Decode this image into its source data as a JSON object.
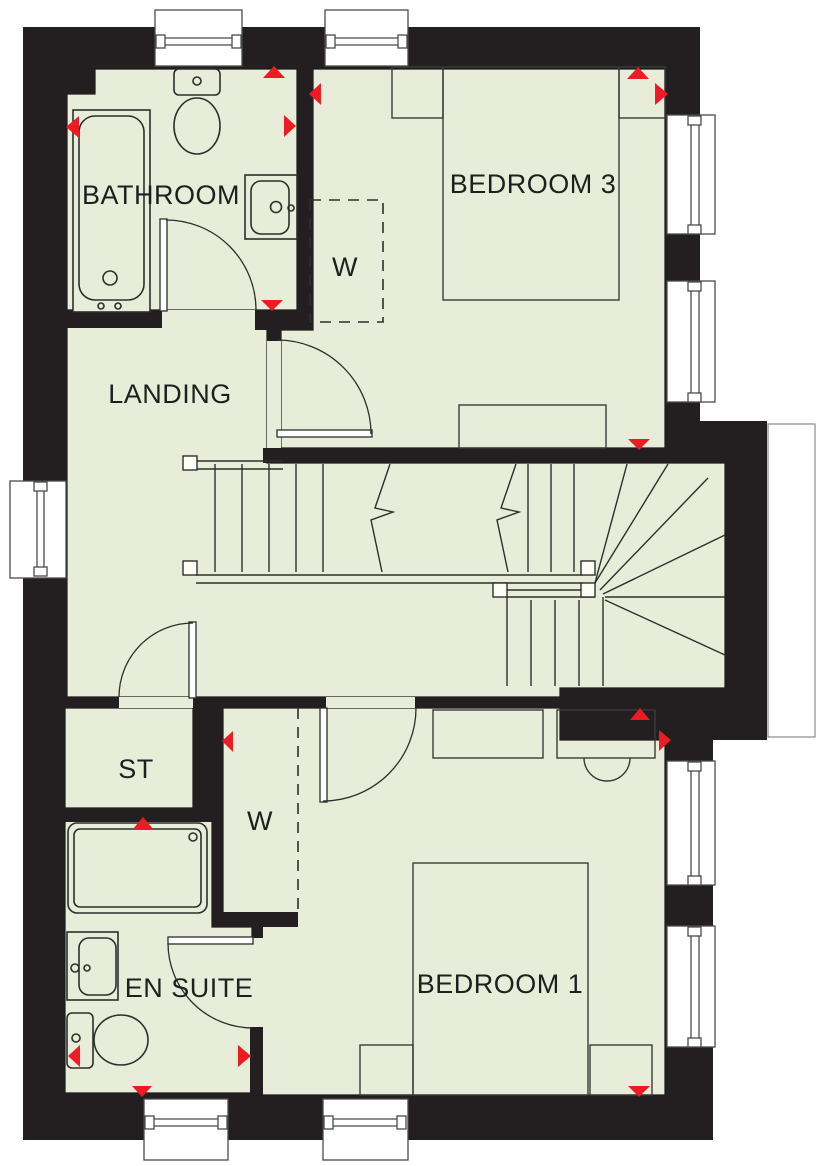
{
  "plan": {
    "rooms": [
      {
        "id": "bathroom",
        "label": "BATHROOM"
      },
      {
        "id": "bedroom-3",
        "label": "BEDROOM 3"
      },
      {
        "id": "wardrobe-bedroom-3",
        "label": "W"
      },
      {
        "id": "landing",
        "label": "LANDING"
      },
      {
        "id": "store",
        "label": "ST"
      },
      {
        "id": "wardrobe-bedroom-1",
        "label": "W"
      },
      {
        "id": "en-suite",
        "label": "EN SUITE"
      },
      {
        "id": "bedroom-1",
        "label": "BEDROOM 1"
      }
    ],
    "colors": {
      "floor": "#e7edd8",
      "wall": "#231f20",
      "marker": "#ed1c24",
      "line": "#2e2e2e",
      "background": "#ffffff"
    }
  }
}
